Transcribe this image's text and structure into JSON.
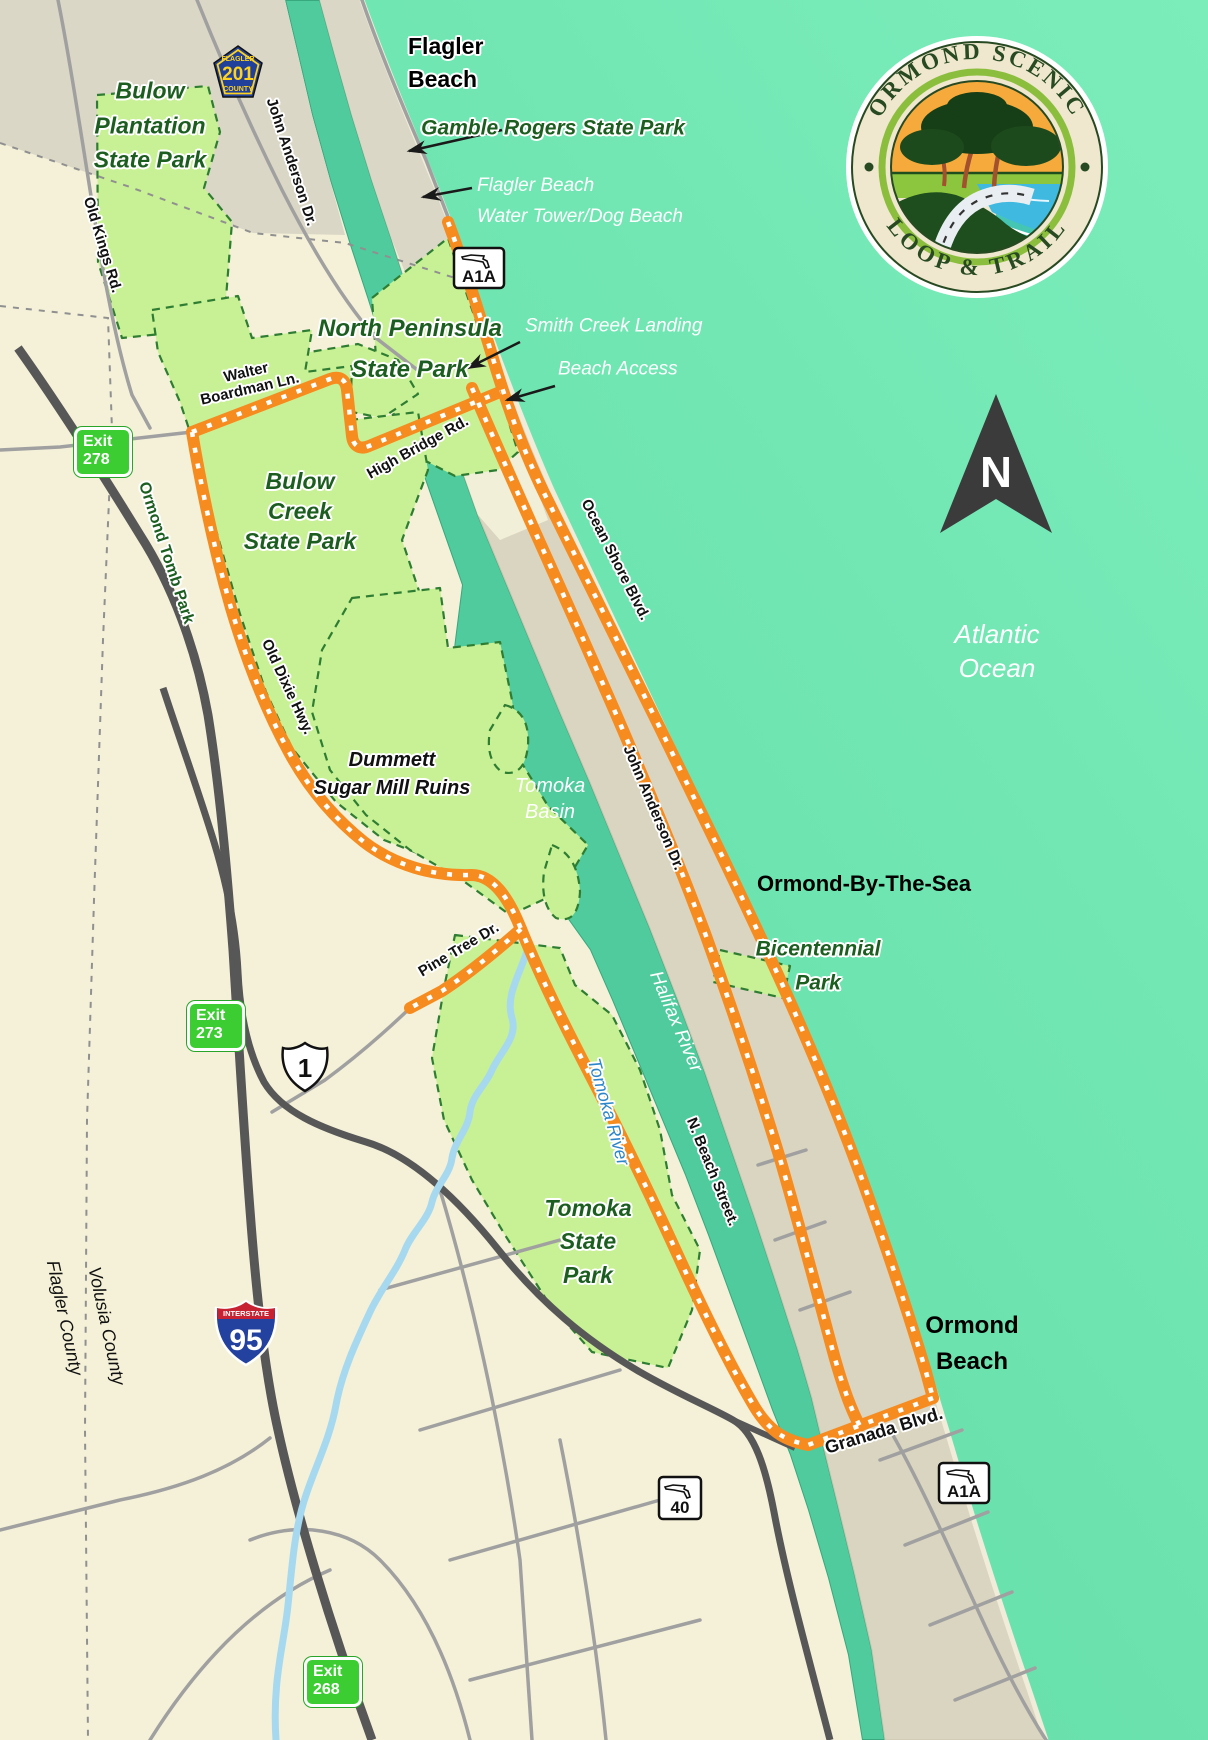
{
  "logo": {
    "arc_top": "ORMOND SCENIC",
    "arc_bottom": "LOOP & TRAIL"
  },
  "compass_n": "N",
  "cities": {
    "flagler_beach": {
      "line1": "Flagler",
      "line2": "Beach"
    },
    "ormond_by_the_sea": "Ormond-By-The-Sea",
    "ormond_beach": {
      "line1": "Ormond",
      "line2": "Beach"
    }
  },
  "parks": {
    "bulow_plantation": {
      "line1": "Bulow",
      "line2": "Plantation",
      "line3": "State Park"
    },
    "north_peninsula": {
      "line1": "North Peninsula",
      "line2": "State Park"
    },
    "bulow_creek": {
      "line1": "Bulow",
      "line2": "Creek",
      "line3": "State Park"
    },
    "tomoka": {
      "line1": "Tomoka",
      "line2": "State",
      "line3": "Park"
    },
    "bicentennial": {
      "line1": "Bicentennial",
      "line2": "Park"
    },
    "gamble_rogers": "Gamble Rogers State Park",
    "ormond_tomb": "Ormond Tomb Park"
  },
  "pois": {
    "water_tower": {
      "line1": "Flagler Beach",
      "line2": "Water Tower/Dog Beach"
    },
    "smith_creek": {
      "line1": "Smith Creek Landing",
      "line2": "Beach Access"
    },
    "dummett": {
      "line1": "Dummett",
      "line2": "Sugar Mill Ruins"
    }
  },
  "waters": {
    "atlantic": {
      "line1": "Atlantic",
      "line2": "Ocean"
    },
    "tomoka_basin": {
      "line1": "Tomoka",
      "line2": "Basin"
    },
    "halifax": "Halifax River",
    "tomoka_river": "Tomoka River"
  },
  "roads": {
    "old_kings": "Old Kings Rd.",
    "john_anderson_n": "John Anderson Dr.",
    "walter_boardman": {
      "line1": "Walter",
      "line2": "Boardman Ln."
    },
    "high_bridge": "High Bridge Rd.",
    "ocean_shore": "Ocean Shore Blvd.",
    "john_anderson_s": "John Anderson Dr.",
    "old_dixie": "Old Dixie Hwy.",
    "pine_tree": "Pine Tree Dr.",
    "n_beach": "N. Beach Street.",
    "granada": "Granada Blvd."
  },
  "counties": {
    "flagler": "Flagler County",
    "volusia": "Volusia County"
  },
  "shields": {
    "county201": {
      "county": "FLAGLER",
      "number": "201",
      "word": "COUNTY"
    },
    "a1a_north": "A1A",
    "a1a_south": "A1A",
    "us1": "1",
    "i95": {
      "word": "INTERSTATE",
      "number": "95"
    },
    "sr40": "40"
  },
  "exits": {
    "e278": {
      "word": "Exit",
      "number": "278"
    },
    "e273": {
      "word": "Exit",
      "number": "273"
    },
    "e268": {
      "word": "Exit",
      "number": "268"
    }
  },
  "colors": {
    "ocean": "#6fe4b0",
    "river": "#4fcb9d",
    "land": "#f4f1d8",
    "flagler_land": "#dbd7c6",
    "island": "#dad5c0",
    "park": "#c8f094",
    "trail": "#f68b1f",
    "exit_green": "#3ccd33",
    "interstate_blue": "#23419e",
    "interstate_red": "#c62231"
  }
}
